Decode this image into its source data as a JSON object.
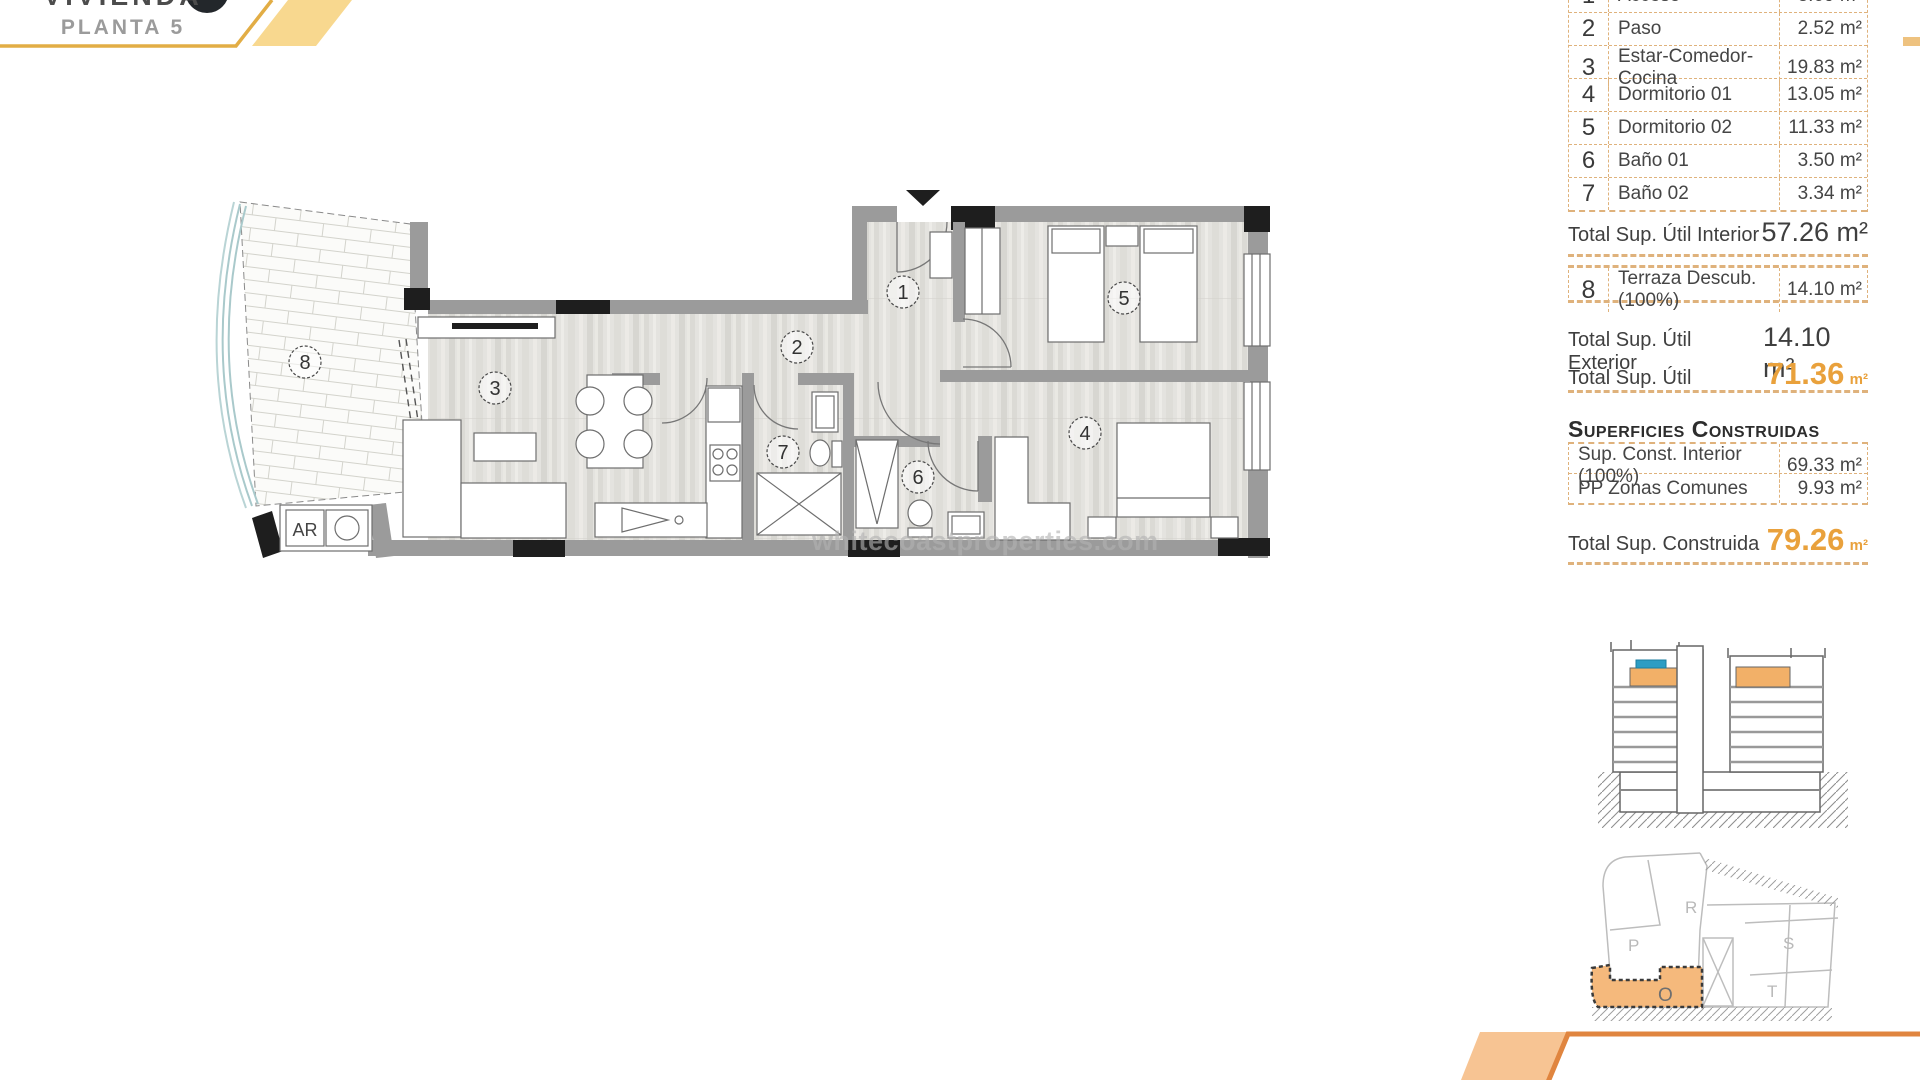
{
  "header": {
    "title": "VIVIENDA",
    "floor": "PLANTA 5"
  },
  "watermark": "whitecoastproperties.com",
  "plan": {
    "room_numbers": [
      "1",
      "2",
      "3",
      "4",
      "5",
      "6",
      "7",
      "8"
    ],
    "ar_label": "AR"
  },
  "areas": {
    "rows": [
      {
        "num": "1",
        "name": "Acceso",
        "value": "3.69 m²"
      },
      {
        "num": "2",
        "name": "Paso",
        "value": "2.52 m²"
      },
      {
        "num": "3",
        "name": "Estar-Comedor-Cocina",
        "value": "19.83 m²"
      },
      {
        "num": "4",
        "name": "Dormitorio 01",
        "value": "13.05 m²"
      },
      {
        "num": "5",
        "name": "Dormitorio 02",
        "value": "11.33 m²"
      },
      {
        "num": "6",
        "name": "Baño 01",
        "value": "3.50 m²"
      },
      {
        "num": "7",
        "name": "Baño 02",
        "value": "3.34 m²"
      }
    ],
    "total_interior": {
      "label": "Total Sup. Útil Interior",
      "value": "57.26 m²"
    },
    "terrace_row": {
      "num": "8",
      "name": "Terraza Descub.(100%)",
      "value": "14.10 m²"
    },
    "total_exterior": {
      "label": "Total Sup. Útil Exterior",
      "value": "14.10 m²"
    },
    "total_util": {
      "label": "Total Sup. Útil",
      "value": "71.36",
      "unit": "m²"
    },
    "constructed_heading": "Superficies Construidas",
    "constructed_rows": [
      {
        "label": "Sup. Const. Interior (100%)",
        "value": "69.33 m²"
      },
      {
        "label": "PP Zonas Comunes",
        "value": "9.93 m²"
      }
    ],
    "total_constructed": {
      "label": "Total Sup. Construida",
      "value": "79.26",
      "unit": "m²"
    }
  },
  "site_plan": {
    "labels": {
      "r": "R",
      "p": "P",
      "s": "S",
      "t": "T",
      "o": "O"
    }
  },
  "colors": {
    "accent_orange": "#E9A13C",
    "table_tan": "#DFB27C",
    "header_tan": "#F8D88F",
    "gold_border": "#E2AD45",
    "footer_orange": "#E0853F",
    "footer_tan": "#F7C493",
    "wall_gray": "#9B9B9B",
    "wall_black": "#1E1E1E",
    "section_orange": "#F2B068",
    "section_blue": "#2D9DC4"
  }
}
